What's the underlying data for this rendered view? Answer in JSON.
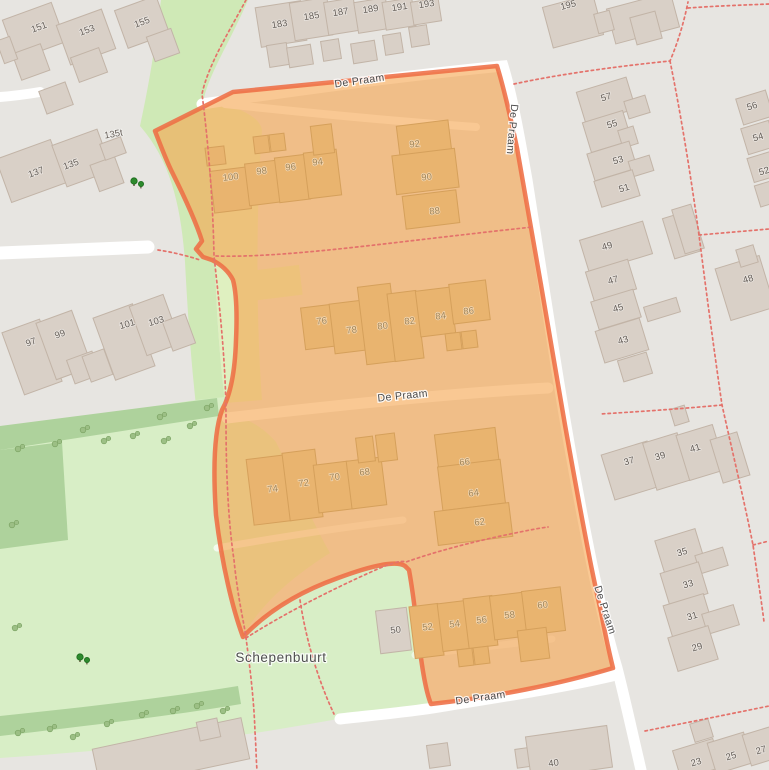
{
  "map": {
    "colors": {
      "bg": "#e7e5e1",
      "road": "#ffffff",
      "park": "#d8eec6",
      "park_dark": "#aed29c",
      "green_strip": "#cfe9b6",
      "grass_under": "#dff0c0",
      "building": "#d9d0c7",
      "building_outline": "#c2b4a7",
      "building_hl": "#e9b46f",
      "building_hl_outline": "#d5a05b",
      "highlight_fill": "rgba(245,166,80,0.62)",
      "highlight_border": "rgba(238,110,70,0.88)",
      "path_red": "#e4726b",
      "tree_light": "#9cbf85",
      "tree_light_edge": "#7da465",
      "tree_dark": "#2d8a2d",
      "street_label": "#4a4a4a",
      "place_label": "#4f4f4f",
      "hn_grey": "#67605a",
      "hn_orange": "#a08457"
    },
    "place_label": {
      "text": "Schepenbuurt",
      "x": 281,
      "y": 662
    },
    "street_labels": [
      {
        "text": "De Praam",
        "x": 360,
        "y": 84,
        "rot": -8
      },
      {
        "text": "De Praam",
        "x": 509,
        "y": 129,
        "rot": 95
      },
      {
        "text": "De Praam",
        "x": 403,
        "y": 399,
        "rot": -6
      },
      {
        "text": "De Praam",
        "x": 602,
        "y": 611,
        "rot": 72
      },
      {
        "text": "De Praam",
        "x": 481,
        "y": 701,
        "rot": -8
      }
    ],
    "house_numbers_grey": [
      {
        "t": "151",
        "x": 40,
        "y": 30,
        "r": -20
      },
      {
        "t": "153",
        "x": 88,
        "y": 33,
        "r": -20
      },
      {
        "t": "155",
        "x": 143,
        "y": 25,
        "r": -20
      },
      {
        "t": "135t",
        "x": 114,
        "y": 137,
        "r": -10
      },
      {
        "t": "137",
        "x": 37,
        "y": 175,
        "r": -20
      },
      {
        "t": "135",
        "x": 72,
        "y": 167,
        "r": -20
      },
      {
        "t": "183",
        "x": 280,
        "y": 27,
        "r": -9
      },
      {
        "t": "185",
        "x": 312,
        "y": 19,
        "r": -9
      },
      {
        "t": "187",
        "x": 341,
        "y": 15,
        "r": -9
      },
      {
        "t": "189",
        "x": 371,
        "y": 12,
        "r": -9
      },
      {
        "t": "191",
        "x": 400,
        "y": 10,
        "r": -9
      },
      {
        "t": "193",
        "x": 427,
        "y": 7,
        "r": -9
      },
      {
        "t": "195",
        "x": 569,
        "y": 8,
        "r": -15
      },
      {
        "t": "57",
        "x": 607,
        "y": 100,
        "r": -17
      },
      {
        "t": "55",
        "x": 613,
        "y": 127,
        "r": -17
      },
      {
        "t": "53",
        "x": 619,
        "y": 163,
        "r": -17
      },
      {
        "t": "51",
        "x": 625,
        "y": 191,
        "r": -17
      },
      {
        "t": "56",
        "x": 753,
        "y": 109,
        "r": -17
      },
      {
        "t": "54",
        "x": 759,
        "y": 140,
        "r": -17
      },
      {
        "t": "52",
        "x": 765,
        "y": 174,
        "r": -17
      },
      {
        "t": "49",
        "x": 608,
        "y": 249,
        "r": -17
      },
      {
        "t": "47",
        "x": 614,
        "y": 283,
        "r": -17
      },
      {
        "t": "45",
        "x": 619,
        "y": 311,
        "r": -17
      },
      {
        "t": "43",
        "x": 624,
        "y": 343,
        "r": -17
      },
      {
        "t": "48",
        "x": 749,
        "y": 282,
        "r": -17
      },
      {
        "t": "97",
        "x": 32,
        "y": 345,
        "r": -20
      },
      {
        "t": "99",
        "x": 61,
        "y": 337,
        "r": -20
      },
      {
        "t": "101",
        "x": 128,
        "y": 327,
        "r": -16
      },
      {
        "t": "103",
        "x": 157,
        "y": 324,
        "r": -16
      },
      {
        "t": "37",
        "x": 630,
        "y": 464,
        "r": -17
      },
      {
        "t": "39",
        "x": 661,
        "y": 459,
        "r": -17
      },
      {
        "t": "41",
        "x": 696,
        "y": 451,
        "r": -17
      },
      {
        "t": "35",
        "x": 683,
        "y": 555,
        "r": -17
      },
      {
        "t": "33",
        "x": 689,
        "y": 587,
        "r": -17
      },
      {
        "t": "31",
        "x": 693,
        "y": 619,
        "r": -17
      },
      {
        "t": "29",
        "x": 698,
        "y": 650,
        "r": -17
      },
      {
        "t": "50",
        "x": 396,
        "y": 633,
        "r": -7
      },
      {
        "t": "40",
        "x": 554,
        "y": 766,
        "r": -8
      },
      {
        "t": "23",
        "x": 697,
        "y": 765,
        "r": -17
      },
      {
        "t": "25",
        "x": 732,
        "y": 759,
        "r": -17
      },
      {
        "t": "27",
        "x": 762,
        "y": 753,
        "r": -17
      }
    ],
    "house_numbers_orange": [
      {
        "t": "100",
        "x": 231,
        "y": 180,
        "r": -7
      },
      {
        "t": "98",
        "x": 262,
        "y": 174,
        "r": -7
      },
      {
        "t": "96",
        "x": 291,
        "y": 170,
        "r": -7
      },
      {
        "t": "94",
        "x": 318,
        "y": 165,
        "r": -7
      },
      {
        "t": "92",
        "x": 415,
        "y": 147,
        "r": -7
      },
      {
        "t": "90",
        "x": 427,
        "y": 180,
        "r": -7
      },
      {
        "t": "88",
        "x": 435,
        "y": 214,
        "r": -7
      },
      {
        "t": "76",
        "x": 322,
        "y": 324,
        "r": -7
      },
      {
        "t": "78",
        "x": 352,
        "y": 333,
        "r": -7
      },
      {
        "t": "80",
        "x": 383,
        "y": 329,
        "r": -7
      },
      {
        "t": "82",
        "x": 410,
        "y": 324,
        "r": -7
      },
      {
        "t": "84",
        "x": 441,
        "y": 319,
        "r": -7
      },
      {
        "t": "86",
        "x": 469,
        "y": 314,
        "r": -7
      },
      {
        "t": "74",
        "x": 273,
        "y": 492,
        "r": -7
      },
      {
        "t": "72",
        "x": 304,
        "y": 486,
        "r": -7
      },
      {
        "t": "70",
        "x": 335,
        "y": 480,
        "r": -7
      },
      {
        "t": "68",
        "x": 365,
        "y": 475,
        "r": -7
      },
      {
        "t": "66",
        "x": 465,
        "y": 465,
        "r": -7
      },
      {
        "t": "64",
        "x": 474,
        "y": 496,
        "r": -7
      },
      {
        "t": "62",
        "x": 480,
        "y": 525,
        "r": -7
      },
      {
        "t": "52",
        "x": 428,
        "y": 630,
        "r": -7
      },
      {
        "t": "54",
        "x": 455,
        "y": 627,
        "r": -7
      },
      {
        "t": "56",
        "x": 482,
        "y": 623,
        "r": -7
      },
      {
        "t": "58",
        "x": 510,
        "y": 618,
        "r": -7
      },
      {
        "t": "60",
        "x": 543,
        "y": 608,
        "r": -7
      }
    ]
  }
}
